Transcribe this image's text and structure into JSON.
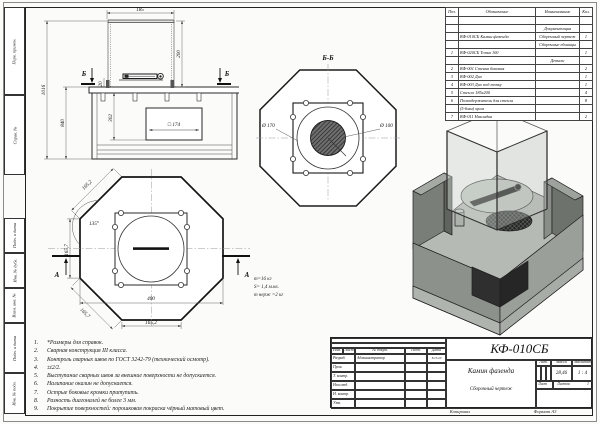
{
  "margin_fields": {
    "f1": "Перв. примен.",
    "f2": "Справ. №",
    "f3": "Подп. и дата",
    "f4": "Инв. № дубл.",
    "f5": "Взам. инв. №",
    "f6": "Подп. и дата",
    "f7": "Инв. № подл."
  },
  "parts_table": {
    "headers": {
      "pos": "Поз.",
      "designation": "Обозначение",
      "name": "Наименование",
      "qty": "Кол."
    },
    "rows": [
      {
        "pos": "",
        "designation": "",
        "name": "",
        "qty": ""
      },
      {
        "pos": "",
        "designation": "",
        "name": "Документация",
        "qty": ""
      },
      {
        "pos": "",
        "designation": "КФ-010СБ Камин фазенда",
        "name": "Сборочный чертеж",
        "qty": "1"
      },
      {
        "pos": "",
        "designation": "",
        "name": "Сборочные единицы",
        "qty": ""
      },
      {
        "pos": "1",
        "designation": "КФ-020СБ Топка 100",
        "name": "",
        "qty": "1"
      },
      {
        "pos": "",
        "designation": "",
        "name": "Детали",
        "qty": ""
      },
      {
        "pos": "2",
        "designation": "КФ-001 Стенка боковая",
        "name": "",
        "qty": "2"
      },
      {
        "pos": "3",
        "designation": "КФ-002 Дно",
        "name": "",
        "qty": "1"
      },
      {
        "pos": "4",
        "designation": "КФ-003 Дно под топку",
        "name": "",
        "qty": "1"
      },
      {
        "pos": "5",
        "designation": "Стекло 185х200",
        "name": "",
        "qty": "4"
      },
      {
        "pos": "6",
        "designation": "Полкодержатель для стекла",
        "name": "",
        "qty": "8"
      },
      {
        "pos": "",
        "designation": "(5-6мм) хром",
        "name": "",
        "qty": ""
      },
      {
        "pos": "7",
        "designation": "КФ-011 Накладка",
        "name": "",
        "qty": "2"
      }
    ]
  },
  "front_view": {
    "dim_width_top": "185",
    "dim_glass_height": "200",
    "dim_offset": "20",
    "dim_total_height": "1016",
    "dim_base_height": "840",
    "dim_inner_height": "302",
    "dim_square": "□ 174",
    "section_label_left": "Б",
    "section_label_right": "Б"
  },
  "section_bb": {
    "title": "Б-Б",
    "dim_d170": "Ø 170",
    "dim_d100": "Ø 100"
  },
  "top_view": {
    "dim_edge_top": "165,2",
    "dim_angle": "135°",
    "dim_side_left": "165,7",
    "dim_edge_bottom_left": "165,7",
    "dim_width": "400",
    "dim_edge_bottom": "165,2",
    "section_label_left": "А",
    "section_label_right": "А"
  },
  "mass_note": {
    "line1": "m=16 кг",
    "line2": "S= 1,4 м.кв.",
    "line3": "m нерж =2 кг"
  },
  "notes": {
    "items": [
      {
        "num": "1.",
        "text": "*Размеры для справок."
      },
      {
        "num": "2.",
        "text": "Сварная конструкция III класса."
      },
      {
        "num": "3.",
        "text": "Контроль сварных швов по ГОСТ 3242-79 (технический осмотр)."
      },
      {
        "num": "4.",
        "text": "±t2/2."
      },
      {
        "num": "5.",
        "text": "Выступание сварных швов за внешние поверхности не допускается."
      },
      {
        "num": "6.",
        "text": "Налипание окалин не допускается."
      },
      {
        "num": "7.",
        "text": "Острые боковые кромки притупить."
      },
      {
        "num": "8.",
        "text": "Разность диагоналей не более 3 мм."
      },
      {
        "num": "9.",
        "text": "Покрытие поверхностей: порошковая покраска чёрный матовый цвет."
      }
    ]
  },
  "title_block": {
    "doc_number": "КФ-010СБ",
    "product_name": "Камин фазенда",
    "doc_type": "Сборочный чертеж",
    "header": {
      "izm": "Изм.",
      "list": "Лист",
      "doc": "№ докум.",
      "podp": "Подп.",
      "data": "Дата"
    },
    "rows": {
      "razrab": "Разраб.",
      "prov": "Пров.",
      "tkontr": "Т. контр.",
      "nachotd": "Нач.отд.",
      "nkontr": "Н. контр.",
      "utv": "Утв."
    },
    "razrab_name": "Администратор",
    "razrab_date": "8.15.20",
    "lit_label": "Лит.",
    "mass_label": "Масса",
    "scale_label": "Масштаб",
    "mass_value": "28,46",
    "scale_value": "1 : 4",
    "sheet_label": "Лист",
    "sheets_label": "Листов",
    "sheets_value": "1",
    "copied_label": "Копировал",
    "format_label": "Формат А3"
  },
  "colors": {
    "line": "#2a2a2a",
    "dim": "#555555",
    "metal_light": "#b6bab5",
    "metal_dark": "#6e726d"
  }
}
